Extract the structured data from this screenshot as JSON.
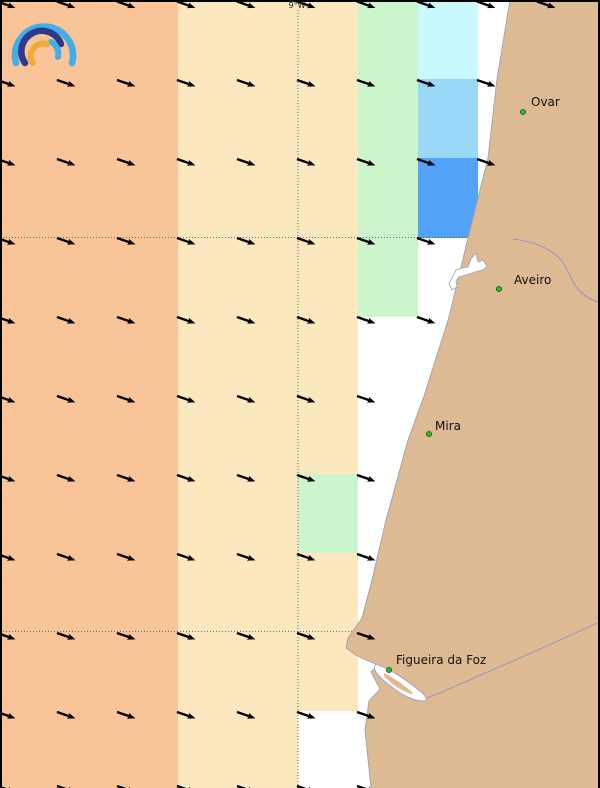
{
  "map": {
    "width": 600,
    "height": 788,
    "meridian_label": "9°W",
    "colors": {
      "ocean": "#ffffff",
      "land": "#DEBA94",
      "coast_line": "#9AA4B0",
      "orange": "#F8C498",
      "cream": "#FBE8BE",
      "green": "#CDF5CB",
      "cyan": "#C9F9FE",
      "light_blue": "#9AD8F8",
      "blue": "#52A3F9",
      "river": "#9B96C2",
      "grid": "#444444",
      "arrow": "#000000",
      "border": "#000000",
      "city_dot": "#2DB82D",
      "city_dot_edge": "#1A6B1A",
      "label": "#111111",
      "logo_light_blue": "#41AEEB",
      "logo_navy": "#2F3A8C",
      "logo_orange": "#F2A93B"
    },
    "cells": [
      {
        "x": 0,
        "y": 0,
        "w": 178,
        "h": 788,
        "color": "orange"
      },
      {
        "x": 178,
        "y": 0,
        "w": 120,
        "h": 788,
        "color": "cream"
      },
      {
        "x": 298,
        "y": 0,
        "w": 60,
        "h": 711,
        "color": "cream"
      },
      {
        "x": 298,
        "y": 474,
        "w": 60,
        "h": 79,
        "color": "green"
      },
      {
        "x": 358,
        "y": 0,
        "w": 60,
        "h": 317,
        "color": "green"
      },
      {
        "x": 418,
        "y": 0,
        "w": 60,
        "h": 79,
        "color": "cyan"
      },
      {
        "x": 418,
        "y": 79,
        "w": 60,
        "h": 79,
        "color": "light_blue"
      },
      {
        "x": 418,
        "y": 158,
        "w": 60,
        "h": 80,
        "color": "blue"
      }
    ],
    "gridlines": {
      "meridian_x": 298,
      "parallels_y": [
        237.5,
        631.5
      ]
    },
    "coast": [
      [
        510,
        0
      ],
      [
        497,
        79
      ],
      [
        488,
        158
      ],
      [
        468,
        238
      ],
      [
        449,
        317
      ],
      [
        424,
        396
      ],
      [
        408,
        440
      ],
      [
        386,
        520
      ],
      [
        372,
        580
      ],
      [
        362,
        618
      ],
      [
        348,
        638
      ],
      [
        346,
        648
      ],
      [
        356,
        655
      ],
      [
        366,
        660
      ],
      [
        378,
        665
      ],
      [
        371,
        672
      ],
      [
        380,
        689
      ],
      [
        369,
        701
      ],
      [
        365,
        730
      ],
      [
        371,
        788
      ]
    ],
    "rivers": [
      "M513,239 C532,241 550,248 560,259 C568,268 570,279 578,289 C586,298 596,302 604,304",
      "M427,698 C448,690 475,677 497,668 C520,658 556,642 604,620"
    ],
    "lagoon": "M452,278 L456,270 L462,268 L468,267 L471,259 L476,253 L478,262 L483,260 L487,266 L483,270 L475,272 L466,275 L459,277 L456,281 L457,287 L452,290 L449,283 Z",
    "estuary_outer": "M376,664 C390,669 408,681 420,691 C426,696 428,700 425,701 C414,702 400,694 388,684 C379,677 371,669 376,664 Z",
    "estuary_island": "M384,673 C394,678 404,685 412,692 C414,694 412,695 406,692 C397,688 388,681 384,676 Z",
    "arrows": {
      "angle_deg": 19,
      "shaft_len": 13,
      "head_len": 6.5,
      "rows": [
        {
          "y": 1.5,
          "xs": [
            -3,
            57,
            117,
            177,
            237,
            297,
            357,
            417,
            477,
            537
          ]
        },
        {
          "y": 80,
          "xs": [
            -3,
            57,
            117,
            177,
            237,
            297,
            357,
            417,
            477
          ]
        },
        {
          "y": 159,
          "xs": [
            -3,
            57,
            117,
            177,
            237,
            297,
            357,
            417,
            477
          ]
        },
        {
          "y": 238,
          "xs": [
            -3,
            57,
            117,
            177,
            237,
            297,
            357,
            417
          ]
        },
        {
          "y": 317,
          "xs": [
            -3,
            57,
            117,
            177,
            237,
            297,
            357,
            417
          ]
        },
        {
          "y": 396,
          "xs": [
            -3,
            57,
            117,
            177,
            237,
            297,
            357
          ]
        },
        {
          "y": 475,
          "xs": [
            -3,
            57,
            117,
            177,
            237,
            297,
            357
          ]
        },
        {
          "y": 554,
          "xs": [
            -3,
            57,
            117,
            177,
            237,
            297,
            357
          ]
        },
        {
          "y": 633,
          "xs": [
            -3,
            57,
            117,
            177,
            237,
            297,
            357
          ]
        },
        {
          "y": 712,
          "xs": [
            -3,
            57,
            117,
            177,
            237,
            297,
            357
          ]
        },
        {
          "y": 786,
          "xs": [
            -3,
            57,
            117,
            177,
            237,
            297,
            357
          ]
        }
      ]
    },
    "cities": [
      {
        "name": "Ovar",
        "dot": [
          523,
          112
        ],
        "label": [
          531,
          106
        ]
      },
      {
        "name": "Aveiro",
        "dot": [
          499,
          289
        ],
        "label": [
          514,
          284
        ]
      },
      {
        "name": "Mira",
        "dot": [
          429,
          434
        ],
        "label": [
          435,
          430
        ]
      },
      {
        "name": "Figueira da Foz",
        "dot": [
          389,
          670
        ],
        "label": [
          396,
          664
        ]
      }
    ],
    "logo_arcs": [
      {
        "d": "M10,57 A29,29 0 1 1 66,57",
        "color_key": "logo_light_blue",
        "w": 6.5
      },
      {
        "d": "M19,57 A20.5,20.5 0 1 1 55,38",
        "color_key": "logo_navy",
        "w": 6.5
      },
      {
        "d": "M45,36 A13.5,13.5 0 0 1 52,51",
        "color_key": "logo_light_blue",
        "w": 6
      },
      {
        "d": "M27,57 A12.5,12.5 0 0 1 41,38",
        "color_key": "logo_orange",
        "w": 6
      }
    ]
  }
}
